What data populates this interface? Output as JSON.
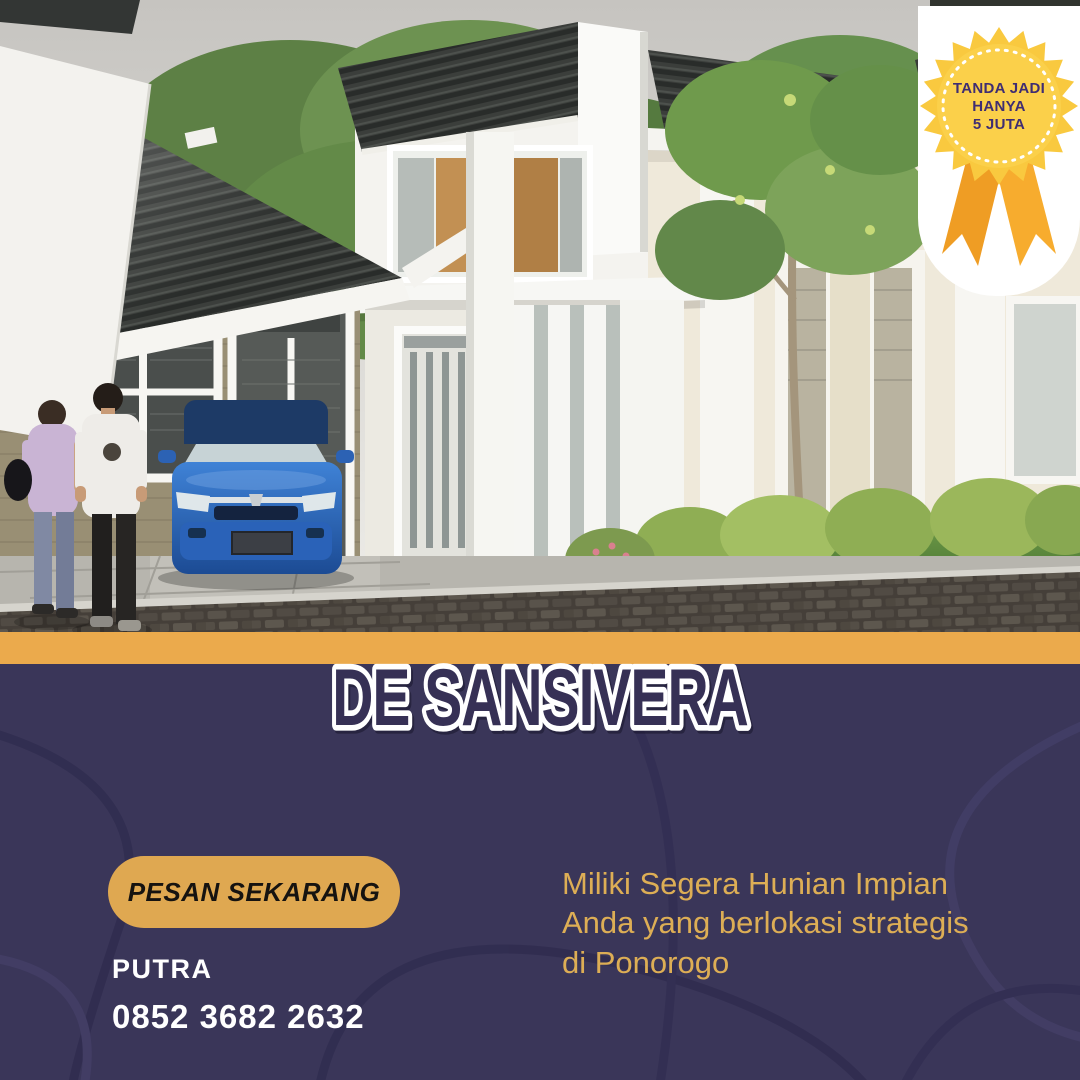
{
  "badge": {
    "line1": "TANDA JADI",
    "line2": "HANYA",
    "line3": "5 JUTA"
  },
  "title": "DE SANSIVERA",
  "cta": {
    "label": "PESAN SEKARANG"
  },
  "contact": {
    "name": "PUTRA",
    "phone": "0852 3682 2632"
  },
  "description": "Miliki Segera Hunian Impian\nAnda yang berlokasi strategis\ndi Ponorogo",
  "colors": {
    "navy_background": "#3a3659",
    "swirl_dark": "#312d50",
    "swirl_light": "#433e66",
    "gold_band": "#ebaa4c",
    "button_gold": "#dfa851",
    "tagline_gold": "#ddae55",
    "badge_yellow": "#f9c93f",
    "ribbon_orange": "#f0a028",
    "badge_text_purple": "#3f2d72",
    "title_fill": "#363055",
    "title_outline": "#ffffff"
  }
}
